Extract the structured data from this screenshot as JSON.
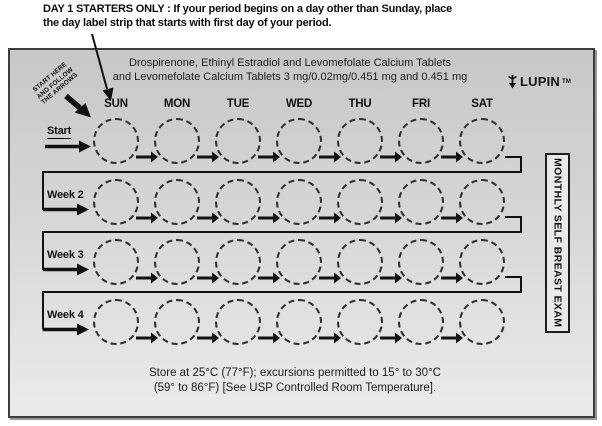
{
  "note": {
    "line1": "DAY 1 STARTERS ONLY : If your period begins on a day other than Sunday, place",
    "line2": "the day label strip that starts with first day of your period."
  },
  "panel": {
    "title_line1": "Drospirenone, Ethinyl Estradiol and Levomefolate Calcium Tablets",
    "title_line2": "and Levomefolate Calcium Tablets 3 mg/0.02mg/0.451 mg and 0.451 mg",
    "brand": {
      "name": "LUPIN",
      "tm": "TM"
    },
    "start_note": {
      "line1": "START HERE",
      "line2": "AND FOLLOW",
      "line3": "THE ARROWS"
    },
    "days": [
      "SUN",
      "MON",
      "TUE",
      "WED",
      "THU",
      "FRI",
      "SAT"
    ],
    "rows": [
      {
        "label": "Start"
      },
      {
        "label": "Week 2"
      },
      {
        "label": "Week 3"
      },
      {
        "label": "Week 4"
      }
    ],
    "side_note": "MONTHLY SELF BREAST EXAM",
    "storage_line1": "Store at 25°C (77°F); excursions permitted to 15° to 30°C",
    "storage_line2": "(59° to 86°F) [See USP Controlled Room Temperature].",
    "colors": {
      "ink": "#111111",
      "panel_top": "#c7c7c7",
      "panel_bottom": "#ebebeb",
      "border": "#3e3e3e"
    }
  }
}
